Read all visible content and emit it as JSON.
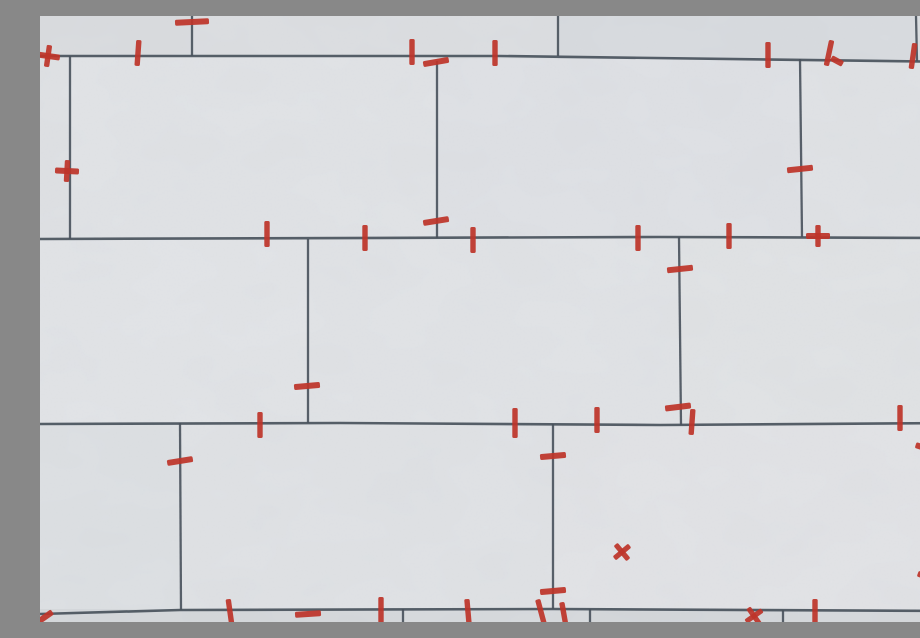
{
  "photo": {
    "subject": "newly-installed light gray wall tiles in running-bond pattern with red plastic tile spacers in the grout joints",
    "width": 920,
    "height": 606
  },
  "colors": {
    "tile_base": "#e1e3e6",
    "grout_line": "#49525c",
    "grout_dark": "#343e48",
    "spacer_red": "#bd352a",
    "noise_tone": "#73787e"
  },
  "tiles": [
    {
      "x": 0,
      "y": 0,
      "w": 153,
      "h": 44,
      "fill": "#dbdde0"
    },
    {
      "x": 153,
      "y": 0,
      "w": 365,
      "h": 44,
      "fill": "#dddfe2"
    },
    {
      "x": 518,
      "y": 0,
      "w": 358,
      "h": 46,
      "fill": "#d9dce0"
    },
    {
      "x": 876,
      "y": 0,
      "w": 44,
      "h": 48,
      "fill": "#dbdee1"
    },
    {
      "x": 0,
      "y": 40,
      "w": 30,
      "h": 184,
      "fill": "#e0e2e5"
    },
    {
      "x": 30,
      "y": 40,
      "w": 367,
      "h": 184,
      "fill": "#e2e4e7"
    },
    {
      "x": 397,
      "y": 43,
      "w": 363,
      "h": 180,
      "fill": "#e0e2e6"
    },
    {
      "x": 760,
      "y": 44,
      "w": 160,
      "h": 178,
      "fill": "#e1e3e6"
    },
    {
      "x": 0,
      "y": 222,
      "w": 268,
      "h": 186,
      "fill": "#e3e5e8"
    },
    {
      "x": 268,
      "y": 221,
      "w": 371,
      "h": 187,
      "fill": "#e2e4e7"
    },
    {
      "x": 639,
      "y": 221,
      "w": 281,
      "h": 187,
      "fill": "#e2e4e6"
    },
    {
      "x": 0,
      "y": 407,
      "w": 140,
      "h": 188,
      "fill": "#dee1e4"
    },
    {
      "x": 140,
      "y": 407,
      "w": 373,
      "h": 187,
      "fill": "#e1e3e6"
    },
    {
      "x": 513,
      "y": 407,
      "w": 376,
      "h": 186,
      "fill": "#e3e4e7"
    },
    {
      "x": 889,
      "y": 407,
      "w": 31,
      "h": 186,
      "fill": "#dfe1e5"
    },
    {
      "x": 0,
      "y": 593,
      "w": 363,
      "h": 13,
      "fill": "#d6d9dc"
    },
    {
      "x": 363,
      "y": 593,
      "w": 187,
      "h": 13,
      "fill": "#d8dbde"
    },
    {
      "x": 550,
      "y": 593,
      "w": 193,
      "h": 13,
      "fill": "#d5d8db"
    },
    {
      "x": 743,
      "y": 594,
      "w": 177,
      "h": 12,
      "fill": "#d7dadd"
    }
  ],
  "grout": {
    "horizontal": [
      {
        "points": "0,40 460,40 920,46"
      },
      {
        "points": "0,223 620,221 920,222"
      },
      {
        "points": "0,408 300,407 620,409 920,407"
      },
      {
        "points": "0,598 140,594 513,593 920,595"
      }
    ],
    "vertical": [
      {
        "x1": 152,
        "y1": 0,
        "x2": 152,
        "y2": 40
      },
      {
        "x1": 518,
        "y1": 0,
        "x2": 518,
        "y2": 40
      },
      {
        "x1": 876,
        "y1": 0,
        "x2": 877,
        "y2": 45
      },
      {
        "x1": 30,
        "y1": 40,
        "x2": 30,
        "y2": 223
      },
      {
        "x1": 397,
        "y1": 45,
        "x2": 397,
        "y2": 222
      },
      {
        "x1": 760,
        "y1": 43,
        "x2": 762,
        "y2": 221
      },
      {
        "x1": 268,
        "y1": 223,
        "x2": 268,
        "y2": 407
      },
      {
        "x1": 639,
        "y1": 221,
        "x2": 641,
        "y2": 409
      },
      {
        "x1": 140,
        "y1": 407,
        "x2": 141,
        "y2": 594
      },
      {
        "x1": 513,
        "y1": 408,
        "x2": 513,
        "y2": 593
      },
      {
        "x1": 887,
        "y1": 407,
        "x2": 895,
        "y2": 595
      },
      {
        "x1": 363,
        "y1": 593,
        "x2": 363,
        "y2": 606
      },
      {
        "x1": 550,
        "y1": 593,
        "x2": 550,
        "y2": 606
      },
      {
        "x1": 743,
        "y1": 594,
        "x2": 743,
        "y2": 606
      }
    ]
  },
  "spacers": [
    {
      "x": 152,
      "y": 6,
      "type": "h",
      "rot": -3,
      "len": 34
    },
    {
      "x": 8,
      "y": 40,
      "type": "plus",
      "rot": 8
    },
    {
      "x": 98,
      "y": 37,
      "type": "v",
      "rot": 4
    },
    {
      "x": 372,
      "y": 36,
      "type": "v",
      "rot": 0
    },
    {
      "x": 396,
      "y": 46,
      "type": "h",
      "rot": -10
    },
    {
      "x": 455,
      "y": 37,
      "type": "v",
      "rot": 0
    },
    {
      "x": 728,
      "y": 39,
      "type": "v",
      "rot": 0
    },
    {
      "x": 789,
      "y": 37,
      "type": "v",
      "rot": 12
    },
    {
      "x": 797,
      "y": 45,
      "type": "h",
      "rot": 28,
      "len": 13
    },
    {
      "x": 873,
      "y": 40,
      "type": "v",
      "rot": 8
    },
    {
      "x": 27,
      "y": 155,
      "type": "plus",
      "rot": 3
    },
    {
      "x": 760,
      "y": 153,
      "type": "h",
      "rot": -6
    },
    {
      "x": 227,
      "y": 218,
      "type": "v",
      "rot": 0
    },
    {
      "x": 396,
      "y": 205,
      "type": "h",
      "rot": -9
    },
    {
      "x": 325,
      "y": 222,
      "type": "v",
      "rot": 0
    },
    {
      "x": 433,
      "y": 224,
      "type": "v",
      "rot": 0
    },
    {
      "x": 598,
      "y": 222,
      "type": "v",
      "rot": 0
    },
    {
      "x": 689,
      "y": 220,
      "type": "v",
      "rot": 0
    },
    {
      "x": 778,
      "y": 220,
      "type": "plus",
      "rot": 0
    },
    {
      "x": 640,
      "y": 253,
      "type": "h",
      "rot": -6
    },
    {
      "x": 267,
      "y": 370,
      "type": "h",
      "rot": -5
    },
    {
      "x": 638,
      "y": 391,
      "type": "h",
      "rot": -7
    },
    {
      "x": 220,
      "y": 409,
      "type": "v",
      "rot": 0
    },
    {
      "x": 475,
      "y": 407,
      "type": "v",
      "rot": 0,
      "len": 30
    },
    {
      "x": 557,
      "y": 404,
      "type": "v",
      "rot": 0
    },
    {
      "x": 652,
      "y": 406,
      "type": "v",
      "rot": 4
    },
    {
      "x": 860,
      "y": 402,
      "type": "v",
      "rot": 0
    },
    {
      "x": 917,
      "y": 403,
      "type": "v",
      "rot": 7
    },
    {
      "x": 140,
      "y": 445,
      "type": "h",
      "rot": -9
    },
    {
      "x": 513,
      "y": 440,
      "type": "h",
      "rot": -5
    },
    {
      "x": 888,
      "y": 433,
      "type": "h",
      "rot": 18
    },
    {
      "x": 582,
      "y": 536,
      "type": "x",
      "rot": 5
    },
    {
      "x": 513,
      "y": 575,
      "type": "h",
      "rot": -5
    },
    {
      "x": 890,
      "y": 562,
      "type": "h",
      "rot": 20
    },
    {
      "x": 5,
      "y": 601,
      "type": "h",
      "rot": -35,
      "len": 18
    },
    {
      "x": 190,
      "y": 596,
      "type": "v",
      "rot": -8
    },
    {
      "x": 268,
      "y": 598,
      "type": "h",
      "rot": -4
    },
    {
      "x": 341,
      "y": 594,
      "type": "v",
      "rot": 0
    },
    {
      "x": 428,
      "y": 596,
      "type": "v",
      "rot": -5
    },
    {
      "x": 501,
      "y": 596,
      "type": "v",
      "rot": -15
    },
    {
      "x": 524,
      "y": 599,
      "type": "v",
      "rot": -10
    },
    {
      "x": 714,
      "y": 600,
      "type": "x",
      "rot": 10
    },
    {
      "x": 775,
      "y": 596,
      "type": "v",
      "rot": 0
    },
    {
      "x": 916,
      "y": 598,
      "type": "v",
      "rot": -8
    }
  ]
}
